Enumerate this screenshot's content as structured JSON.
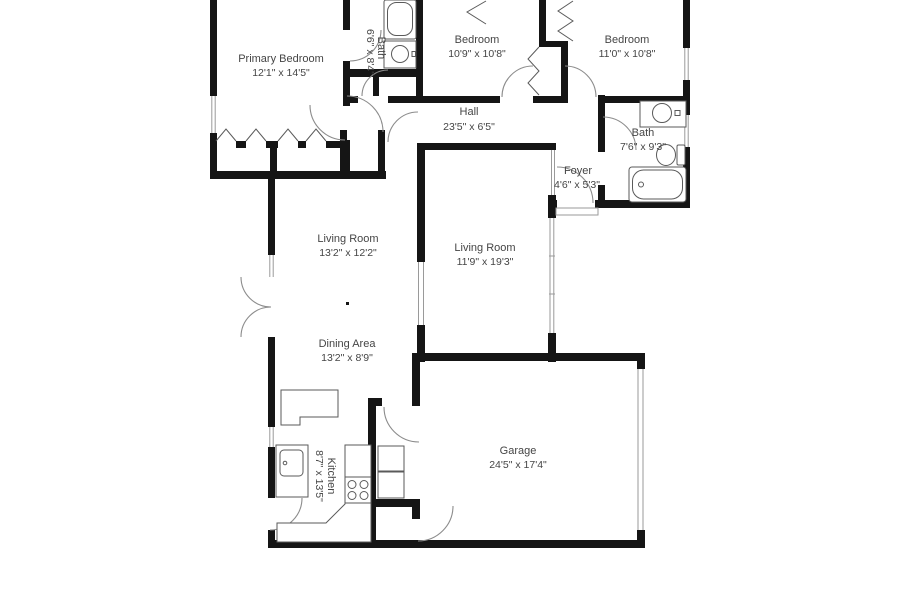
{
  "plan_title": "Floor Plan",
  "colors": {
    "wall": "#151515",
    "label": "#454545",
    "door_arc": "#8c8c8c",
    "fixture": "#5a5a5a",
    "window": "#9a9a9a"
  },
  "rooms": [
    {
      "id": "primary-bedroom",
      "name": "Primary Bedroom",
      "dims": "12'1\" x 14'5\""
    },
    {
      "id": "primary-bath",
      "name": "Bath",
      "dims": "6'6\" x 8'4\""
    },
    {
      "id": "bedroom-1",
      "name": "Bedroom",
      "dims": "10'9\" x 10'8\""
    },
    {
      "id": "bedroom-2",
      "name": "Bedroom",
      "dims": "11'0\" x 10'8\""
    },
    {
      "id": "hall",
      "name": "Hall",
      "dims": "23'5\" x 6'5\""
    },
    {
      "id": "hall-bath",
      "name": "Bath",
      "dims": "7'6\" x 9'3\""
    },
    {
      "id": "foyer",
      "name": "Foyer",
      "dims": "4'6\" x 5'3\""
    },
    {
      "id": "living-room-1",
      "name": "Living Room",
      "dims": "13'2\" x 12'2\""
    },
    {
      "id": "living-room-2",
      "name": "Living Room",
      "dims": "11'9\" x 19'3\""
    },
    {
      "id": "dining-area",
      "name": "Dining Area",
      "dims": "13'2\" x 8'9\""
    },
    {
      "id": "kitchen",
      "name": "Kitchen",
      "dims": "8'7\" x 13'5\""
    },
    {
      "id": "garage",
      "name": "Garage",
      "dims": "24'5\" x 17'4\""
    }
  ]
}
